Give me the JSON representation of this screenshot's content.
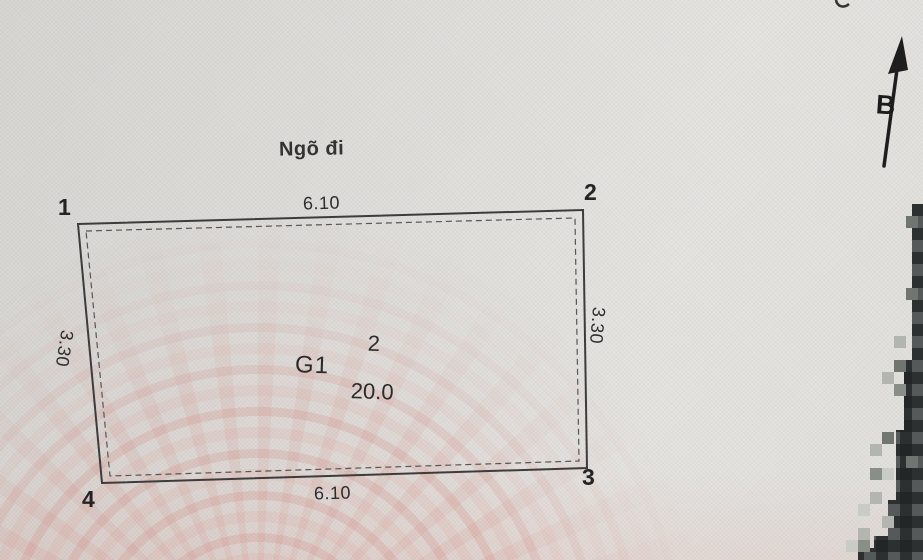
{
  "sketch": {
    "road_label": "Ngõ đi",
    "north_label": "B",
    "parcel": {
      "code": "G1",
      "number": "2",
      "area": "20.0"
    },
    "dimensions": {
      "top": "6.10",
      "bottom": "6.10",
      "left": "3.30",
      "right": "3.30"
    },
    "corners": {
      "c1": "1",
      "c2": "2",
      "c3": "3",
      "c4": "4"
    },
    "colors": {
      "paper": "#e1e0dd",
      "ink": "#3a3a3a",
      "watermark_pink": "#d98a80",
      "censor_dark": "#2c3031"
    }
  }
}
